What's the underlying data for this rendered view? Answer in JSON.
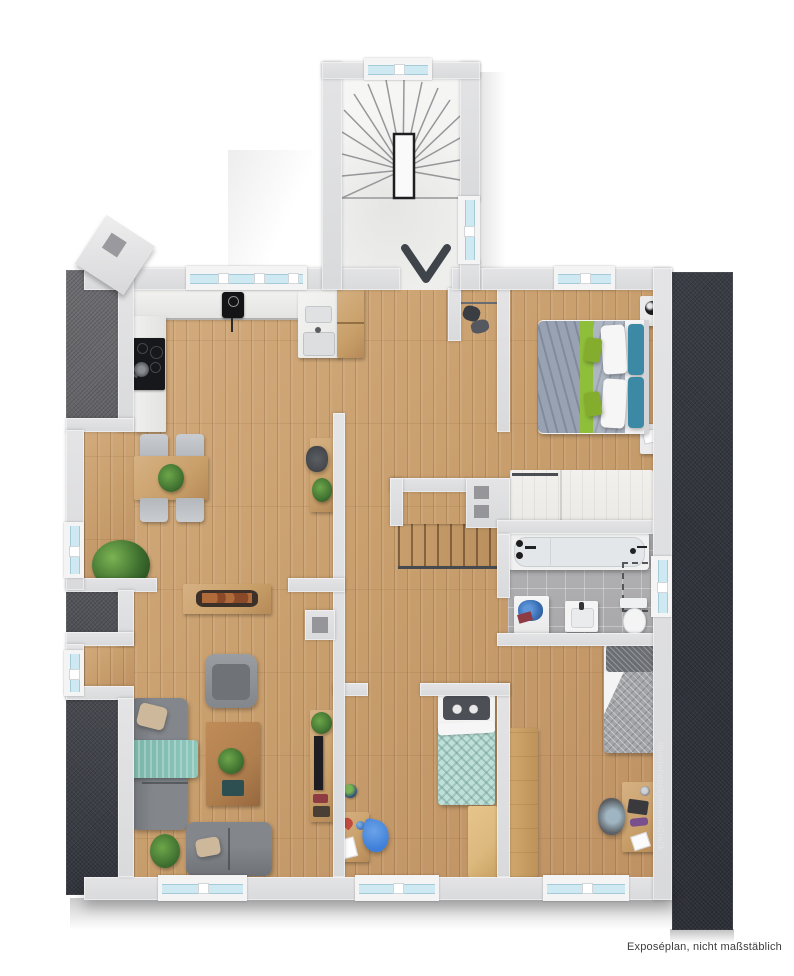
{
  "meta": {
    "type": "apartment-floor-plan-rendering",
    "caption": "Exposéplan, nicht maßstäblich",
    "watermark": "IllustrationsElementeGrafik"
  },
  "plan": {
    "style": "3d-top-down color floor plan, attic storey with sloped-roof strips left and right",
    "stairwell": {
      "position": "top-center",
      "features": [
        "winder-staircase",
        "newel-void",
        "entry-arrow-down",
        "two-windows"
      ]
    },
    "rooms": [
      {
        "name": "kitchen-dining",
        "furniture": [
          "l-shaped-counter",
          "cooktop",
          "sink",
          "wall-device",
          "tall-cabinet",
          "dining-table",
          "four-chairs",
          "floor-plant"
        ]
      },
      {
        "name": "entry-hall",
        "furniture": [
          "wardrobe-cabinet",
          "coat-niche",
          "console-desk",
          "desk-chair",
          "plant",
          "internal-staircase-down",
          "niche-wall-two-squares"
        ]
      },
      {
        "name": "living-room",
        "furniture": [
          "three-seat-sofa",
          "teal-throw-blanket",
          "armchair",
          "coffee-table",
          "two-seat-sofa",
          "sideboard-with-tray",
          "tv-lowboard",
          "plants",
          "chimney-block"
        ]
      },
      {
        "name": "master-bedroom",
        "furniture": [
          "double-bed",
          "two-nightstands",
          "lamp",
          "built-in-closet"
        ]
      },
      {
        "name": "bathroom",
        "furniture": [
          "bathtub",
          "washing-machine",
          "laundry-pile",
          "washbasin",
          "toilet",
          "dashed-shower-area"
        ]
      },
      {
        "name": "kids-room",
        "furniture": [
          "single-bed-mint",
          "penguin-pillow",
          "play-table",
          "toys",
          "beanbag",
          "dresser"
        ]
      },
      {
        "name": "bedroom-right",
        "furniture": [
          "single-bed-gray",
          "wardrobe",
          "desk",
          "office-chair",
          "laptop"
        ]
      }
    ],
    "windows": [
      "kitchen-top",
      "master-top",
      "stairwell-top",
      "stairwell-right",
      "bath-right",
      "living-left-upper",
      "living-left-lower",
      "living-bottom",
      "kids-bottom",
      "bedroom-bottom"
    ]
  },
  "colors": {
    "wall": "#d9dadc",
    "rooftop": "#6f6f73",
    "roofmid": "#5a5a5f",
    "roofdark": "#31343c",
    "wood": "#c99f6e",
    "kfloor": "#e7e6e3",
    "tile": "#a8a8ab",
    "glass": "#cfe9f3",
    "glassline": "#a4cbd7",
    "frame": "#f4f4f5",
    "oak": "#c9a06a",
    "walnut": "#b07f4e",
    "pine": "#dcb97e",
    "sofa": "#83878c",
    "sofadk": "#6f7378",
    "teal": "#8ec7bc",
    "beige": "#cdb89b",
    "plant": "#3f7030",
    "bedwhite": "#f4f4f5",
    "duvgray": "#99a2b2",
    "duvgray2": "#aeb6c2",
    "throwgreen": "#8fbf3a",
    "cushgreen": "#84ad2e",
    "pillteal": "#3c89a6",
    "mint": "#bfe0d8",
    "kidpill": "#4c4f55",
    "graybed": "#a3a5a8",
    "graybedpill": "#6b6e72",
    "closet": "#eceae7",
    "cooktop": "#17181b",
    "device": "#141416",
    "arrow": "#3f444b",
    "tread": "#97979a",
    "railcol": "#4a4d52",
    "bean": "#3f7fd9",
    "laundry": "#3a6fb5",
    "reditem": "#8e3b44",
    "chairgray": "#b4b7bb",
    "tvdark": "#1e1e22",
    "captioncol": "#3c3c3c"
  }
}
